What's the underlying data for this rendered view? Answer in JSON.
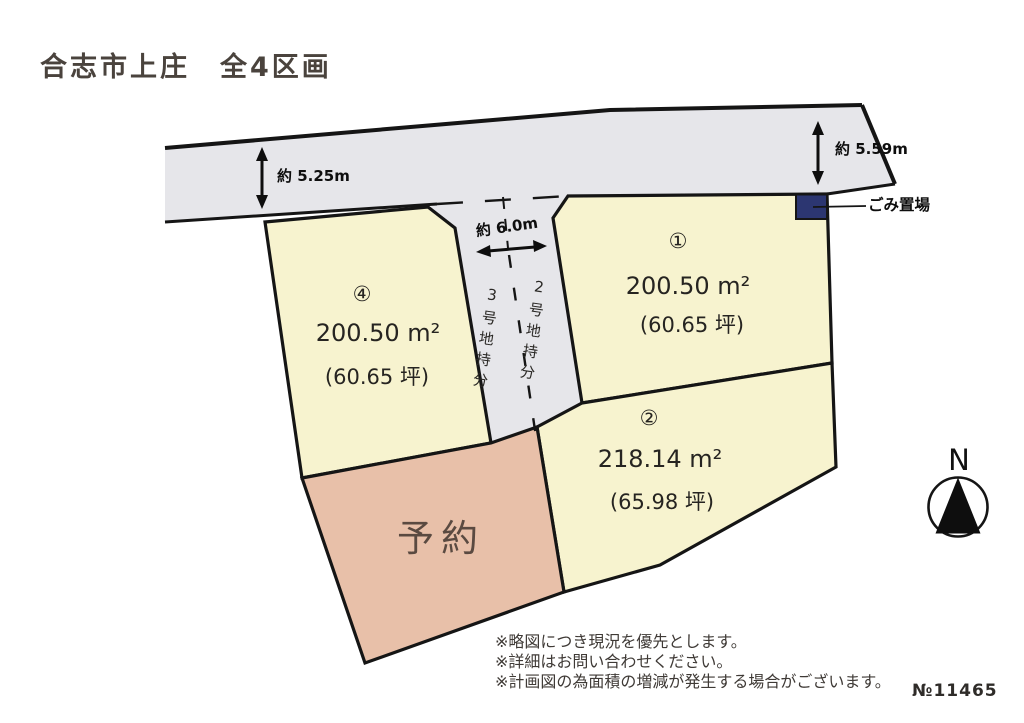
{
  "title": "合志市上庄　全4区画",
  "ref_no": "№11465",
  "compass": {
    "north_label": "N"
  },
  "road": {
    "width_left": "約 5.25m",
    "width_right": "約 5.59m"
  },
  "shared_road": {
    "width": "約 6.0m",
    "left_share_label": "3号地持分",
    "right_share_label": "2号地持分"
  },
  "garbage_station": {
    "label": "ごみ置場"
  },
  "plots": {
    "plot1": {
      "number": "①",
      "area_m2": "200.50 m²",
      "area_tsubo": "(60.65 坪)"
    },
    "plot2": {
      "number": "②",
      "area_m2": "218.14 m²",
      "area_tsubo": "(65.98 坪)"
    },
    "plot4": {
      "number": "④",
      "area_m2": "200.50 m²",
      "area_tsubo": "(60.65 坪)"
    },
    "reserved": {
      "label": "予約"
    }
  },
  "notes": [
    "※略図につき現況を優先とします。",
    "※詳細はお問い合わせください。",
    "※計画図の為面積の増減が発生する場合がございます。"
  ],
  "colors": {
    "plot_fill": "#f7f3cf",
    "reserved_fill": "#e8c0a9",
    "road_fill": "#e6e6ea",
    "garbage_fill": "#2c3671",
    "outline": "#151515"
  }
}
